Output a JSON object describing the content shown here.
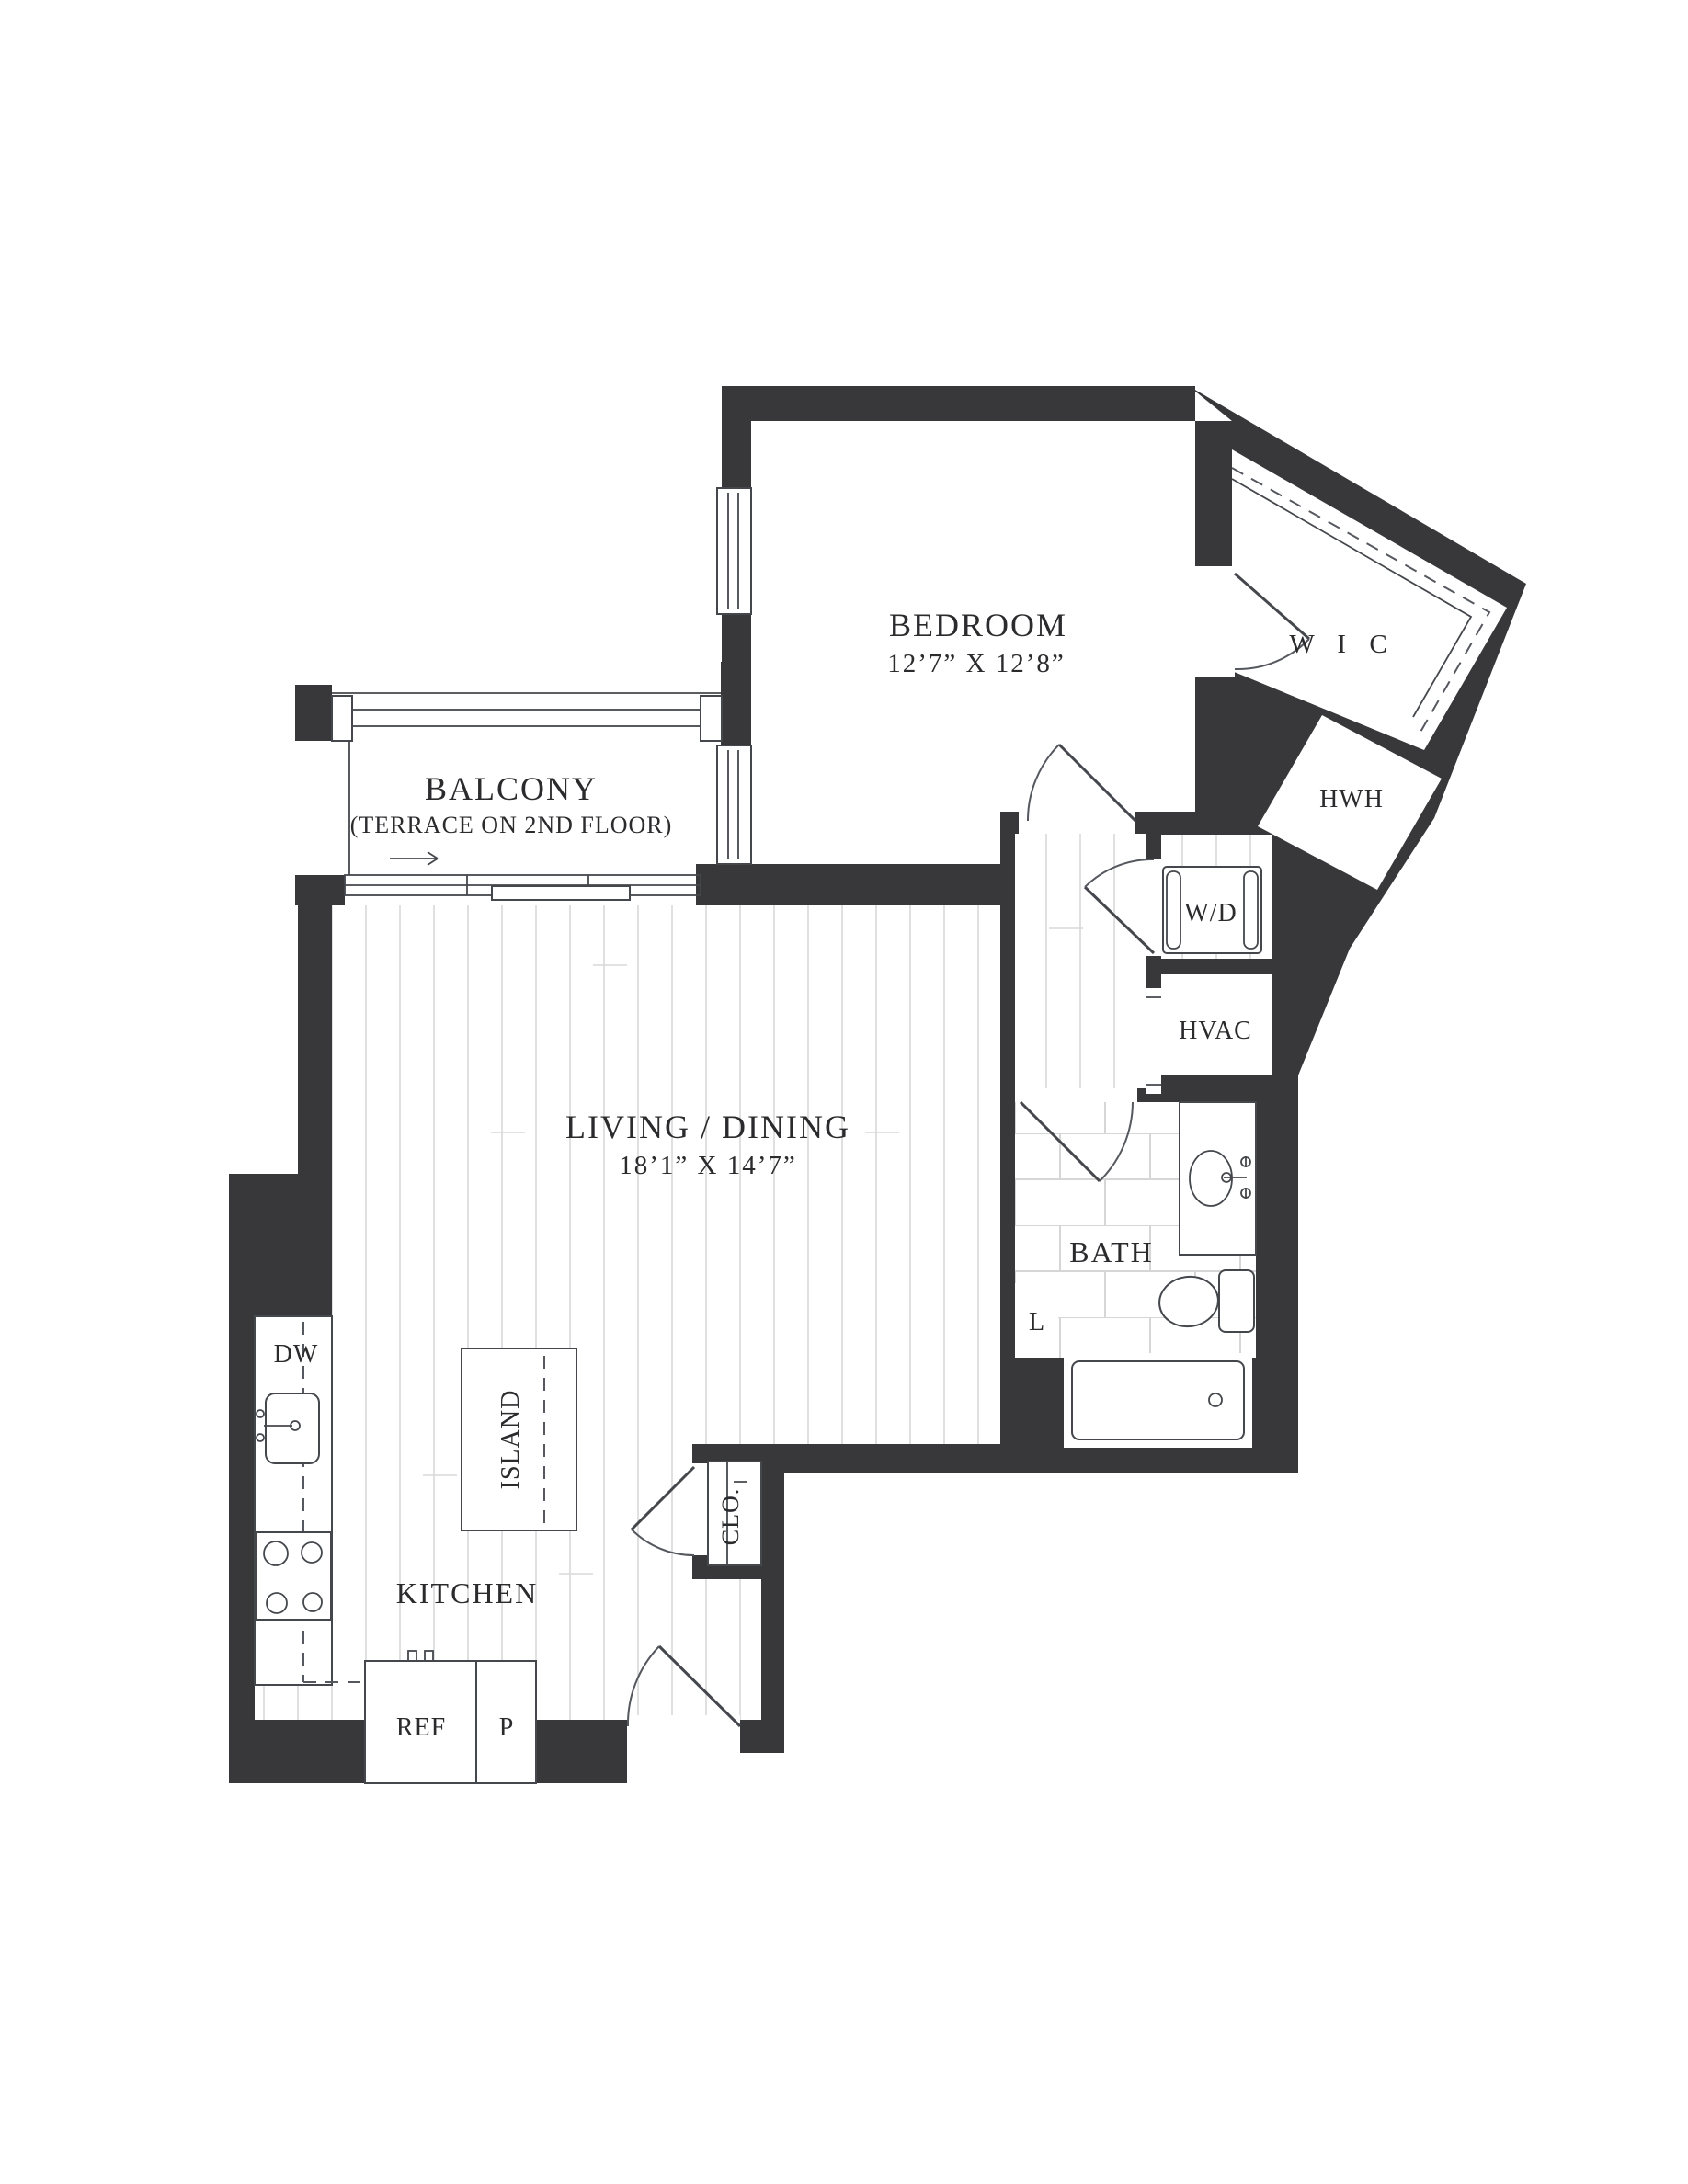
{
  "plan": {
    "type": "apartment-floor-plan",
    "rooms": {
      "bedroom": {
        "label": "BEDROOM",
        "dimensions": "12’7” X 12’8”"
      },
      "balcony": {
        "label": "BALCONY",
        "note": "(TERRACE ON 2ND FLOOR)"
      },
      "living_dining": {
        "label": "LIVING / DINING",
        "dimensions": "18’1” X 14’7”"
      },
      "kitchen": {
        "label": "KITCHEN"
      },
      "bath": {
        "label": "BATH"
      },
      "walk_in_closet": {
        "label": "W I C"
      }
    },
    "fixtures": {
      "island": "ISLAND",
      "dishwasher": "DW",
      "refrigerator": "REF",
      "pantry": "P",
      "coat_closet": "CLO.",
      "linen_closet": "L",
      "washer_dryer": "W/D",
      "hvac": "HVAC",
      "water_heater": "HWH"
    },
    "colors": {
      "wall": "#38383b",
      "fixture_line": "#44474c",
      "floor_line": "#d8d8d8",
      "tile_line": "#d6d6d6",
      "text": "#2b2b2e",
      "background": "#ffffff"
    }
  }
}
